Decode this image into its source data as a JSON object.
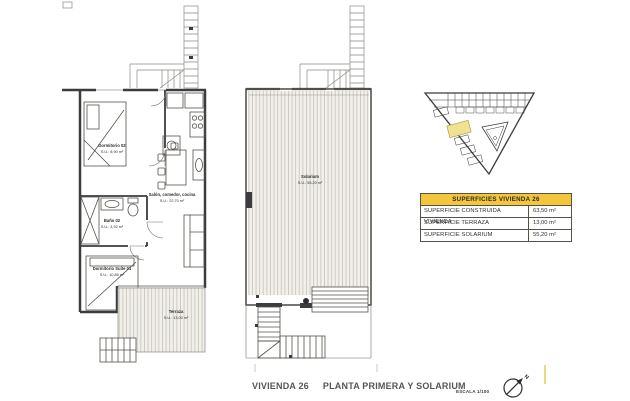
{
  "page": {
    "title_part1": "VIVIENDA 26",
    "title_part2": "PLANTA PRIMERA Y SOLARIUM",
    "scale_label": "ESCALA 1/100"
  },
  "colors": {
    "table_header_yellow": "#F4C63B",
    "site_highlight_yellow": "#F0E291",
    "plan_line_dark": "#3B3B40",
    "hatch_background": "#F2F0EA",
    "hatch_line": "#C9C6BD"
  },
  "surfaces_table": {
    "header": "SUPERFICIES VIVIENDA 26",
    "rows": [
      {
        "label": "SUPERFICIE CONSTRUIDA VIVIENDA",
        "value": "63,50 m²"
      },
      {
        "label": "SUPERFICIE TERRAZA",
        "value": "13,00 m²"
      },
      {
        "label": "SUPERFICIE SOLARIUM",
        "value": "55,20 m²"
      }
    ]
  },
  "floor_plan": {
    "rooms": [
      {
        "name": "Dormitorio 02",
        "area": "S.U.: 8,90 m²"
      },
      {
        "name": "Baño 02",
        "area": "S.U.: 3,92 m²"
      },
      {
        "name": "Dormitorio Suite 01",
        "area": "S.U.: 10,85 m²"
      },
      {
        "name": "Salón, comedor, cocina",
        "area": "S.U.: 22,70 m²"
      },
      {
        "name": "Terraza",
        "area": "S.U.: 13,00 m²"
      }
    ]
  },
  "solarium_plan": {
    "rooms": [
      {
        "name": "Solarium",
        "area": "S.U.: 55,20 m²"
      }
    ]
  },
  "compass": {
    "north_label": "N"
  }
}
